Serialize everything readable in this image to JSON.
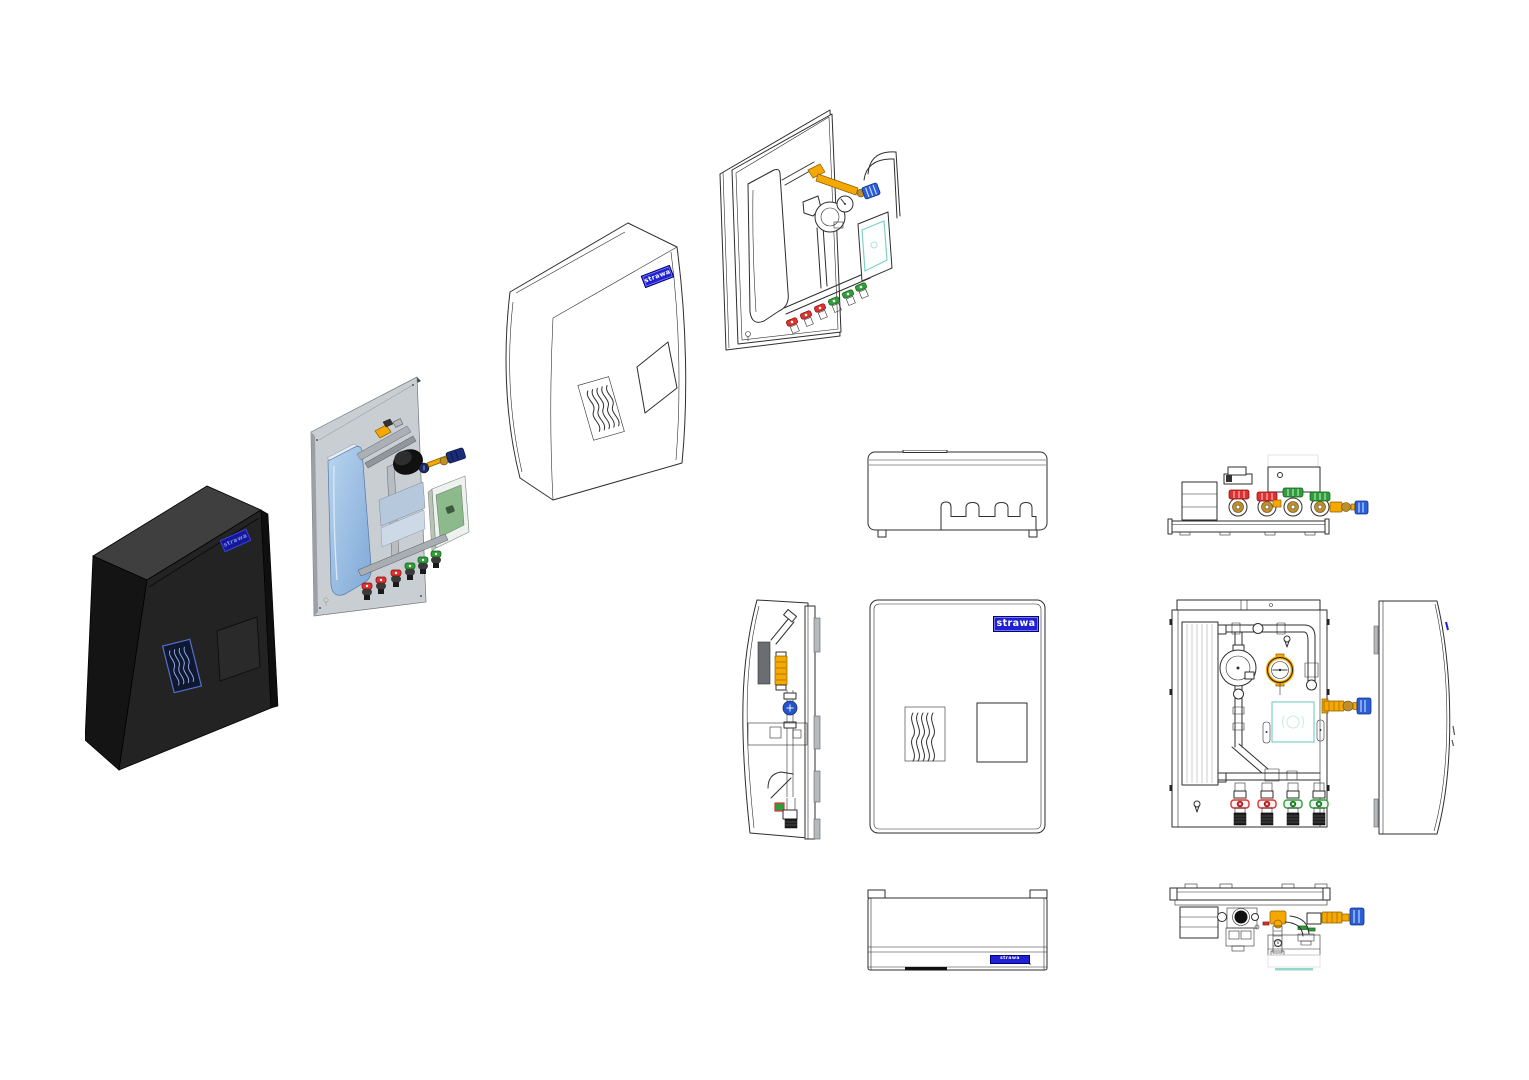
{
  "canvas": {
    "width": 1529,
    "height": 1080,
    "background": "#ffffff"
  },
  "brand": {
    "logo_text": "strawa",
    "logo_bg": "#1f1fd4",
    "logo_border": "#000080",
    "logo_text_color": "#ffffff"
  },
  "palette": {
    "bg": "#ffffff",
    "line": "#2e2e2e",
    "enclosure_top": "#3f3f3f",
    "enclosure_front": "#232323",
    "enclosure_side": "#141414",
    "backplate": "#c9ced3",
    "hx_blue_light": "#b9d4ee",
    "hx_blue": "#7fa9d8",
    "valve_yellow": "#f5a800",
    "handle_red": "#e03030",
    "handle_green": "#2f9e3a",
    "cap_blue": "#2b5fd9",
    "brass": "#bf8f2a",
    "controller_green": "#8cba8c",
    "controller_teal": "#7fd0c4",
    "steel_gray": "#b5b9bd"
  },
  "views": {
    "exploded_sequence": [
      {
        "id": "enclosure-back-iso"
      },
      {
        "id": "hydraulic-module-iso"
      },
      {
        "id": "front-cover-iso"
      },
      {
        "id": "assembled-module-iso"
      }
    ],
    "orthographic": [
      {
        "id": "enclosure-top-view"
      },
      {
        "id": "module-top-view"
      },
      {
        "id": "module-side-view"
      },
      {
        "id": "cover-front-view"
      },
      {
        "id": "module-front-view"
      },
      {
        "id": "cover-side-view"
      },
      {
        "id": "enclosure-bottom-view"
      },
      {
        "id": "module-bottom-view"
      }
    ]
  }
}
